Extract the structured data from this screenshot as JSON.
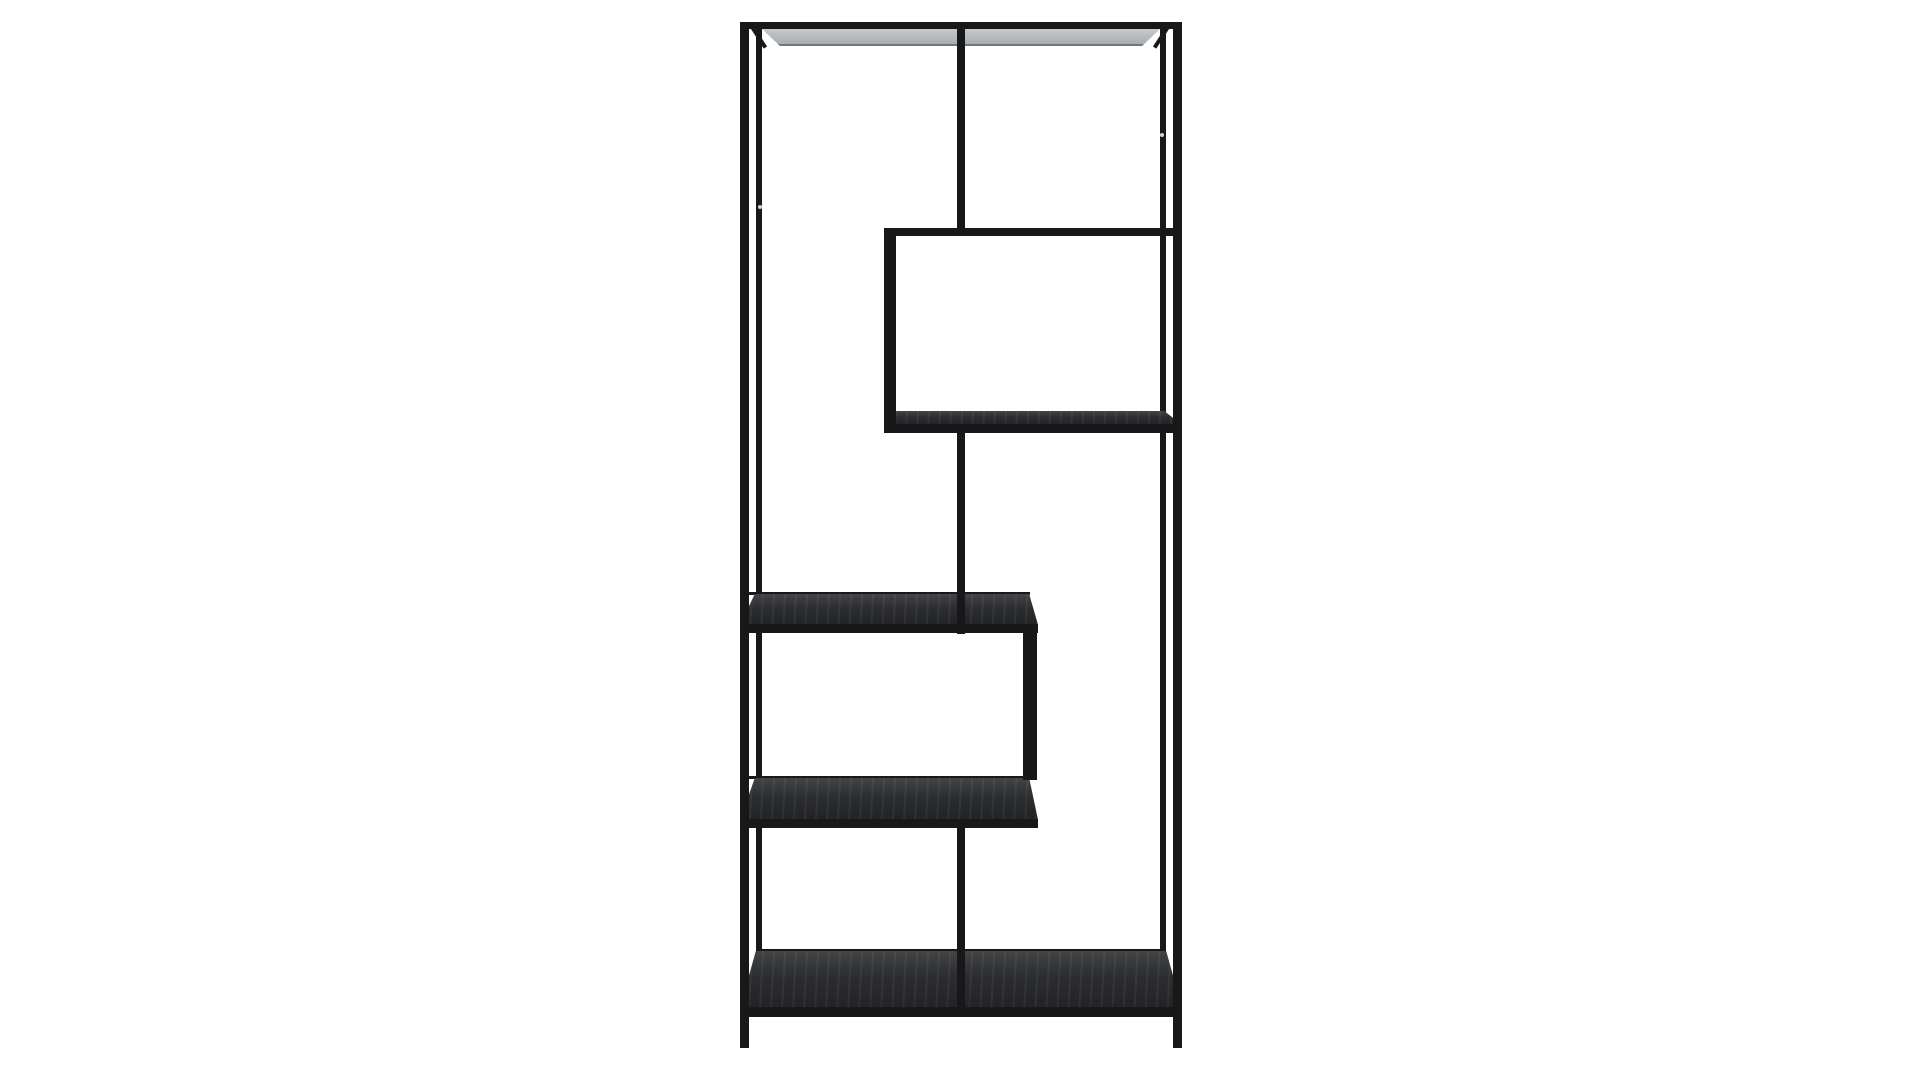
{
  "meta": {
    "image_type": "product-photo",
    "subject": "Tall black metal asymmetric zigzag etagere bookshelf, front view, centered on plain white background",
    "visible_text": "none"
  },
  "palette": {
    "background": "#ffffff",
    "frame": "#18181a",
    "wood_top": "#434446",
    "wood_mid": "#2c2d2f",
    "wood_bottom": "#222325",
    "underside_top": "#c7cacd",
    "underside_bottom": "#a9acb0",
    "underside_edge": "#73767a",
    "screw": "#d2d5d7"
  },
  "scene": {
    "canvas": {
      "width": 1920,
      "height": 1080
    },
    "parts": [
      {
        "name": "back-left-post",
        "kind": "bar",
        "x": 756,
        "y": 28,
        "w": 6,
        "h": 922,
        "z": 1
      },
      {
        "name": "back-right-post",
        "kind": "bar",
        "x": 1160,
        "y": 28,
        "w": 6,
        "h": 922,
        "z": 1
      },
      {
        "name": "top-shelf-underside",
        "kind": "underside",
        "x": 762,
        "y": 29,
        "w": 398,
        "h": 15,
        "z": 1,
        "clip": "polygon(0% 0%, 100% 0%, 95.5% 100%, 4.5% 100%)"
      },
      {
        "name": "top-left-corner-strut",
        "kind": "diag",
        "x": 749,
        "y": 26,
        "w": 4,
        "h": 27,
        "z": 1,
        "rotate": -33,
        "origin": "top left"
      },
      {
        "name": "top-right-corner-strut",
        "kind": "diag",
        "x": 1167,
        "y": 26,
        "w": 4,
        "h": 27,
        "z": 1,
        "rotate": 33,
        "origin": "top right"
      },
      {
        "name": "box-shelf-bottom-surface",
        "kind": "wood",
        "x": 884,
        "y": 411,
        "w": 298,
        "h": 14,
        "z": 2,
        "clip": "polygon(4% 0%, 94% 0%, 100% 100%, 0% 100%)"
      },
      {
        "name": "mid-shelf-back-edge",
        "kind": "bar",
        "x": 748,
        "y": 592,
        "w": 282,
        "h": 3,
        "z": 2
      },
      {
        "name": "mid-shelf-surface",
        "kind": "wood",
        "x": 740,
        "y": 594,
        "w": 298,
        "h": 31,
        "z": 2,
        "clip": "polygon(5% 0%, 97% 0%, 100% 100%, 0% 100%)"
      },
      {
        "name": "lower-shelf-back-edge",
        "kind": "bar",
        "x": 748,
        "y": 776,
        "w": 282,
        "h": 3,
        "z": 2
      },
      {
        "name": "lower-shelf-surface",
        "kind": "wood",
        "x": 740,
        "y": 778,
        "w": 298,
        "h": 42,
        "z": 2,
        "clip": "polygon(5% 0%, 97% 0%, 100% 100%, 0% 100%)"
      },
      {
        "name": "bottom-shelf-back-edge",
        "kind": "bar",
        "x": 756,
        "y": 949,
        "w": 410,
        "h": 3,
        "z": 2
      },
      {
        "name": "bottom-shelf-surface",
        "kind": "wood",
        "x": 740,
        "y": 951,
        "w": 442,
        "h": 57,
        "z": 2,
        "clip": "polygon(3.6% 0%, 96.4% 0%, 100% 100%, 0% 100%)"
      },
      {
        "name": "top-rail",
        "kind": "bar",
        "x": 740,
        "y": 22,
        "w": 442,
        "h": 7,
        "z": 3
      },
      {
        "name": "front-left-post",
        "kind": "bar",
        "x": 740,
        "y": 22,
        "w": 9,
        "h": 1026,
        "z": 3
      },
      {
        "name": "front-right-post",
        "kind": "bar",
        "x": 1173,
        "y": 22,
        "w": 9,
        "h": 1026,
        "z": 3
      },
      {
        "name": "box-shelf-top-rail",
        "kind": "bar",
        "x": 884,
        "y": 228,
        "w": 298,
        "h": 8,
        "z": 3
      },
      {
        "name": "box-shelf-left-wall",
        "kind": "bar",
        "x": 884,
        "y": 228,
        "w": 12,
        "h": 205,
        "z": 3
      },
      {
        "name": "box-shelf-bottom-rail",
        "kind": "bar",
        "x": 884,
        "y": 424,
        "w": 298,
        "h": 9,
        "z": 3
      },
      {
        "name": "mid-shelf-front-rail",
        "kind": "bar",
        "x": 740,
        "y": 624,
        "w": 298,
        "h": 9,
        "z": 3
      },
      {
        "name": "lower-box-right-wall",
        "kind": "bar",
        "x": 1023,
        "y": 630,
        "w": 14,
        "h": 150,
        "z": 3
      },
      {
        "name": "lower-shelf-front-rail",
        "kind": "bar",
        "x": 740,
        "y": 819,
        "w": 298,
        "h": 9,
        "z": 3
      },
      {
        "name": "bottom-shelf-front-rail",
        "kind": "bar",
        "x": 740,
        "y": 1007,
        "w": 442,
        "h": 10,
        "z": 3
      },
      {
        "name": "upper-divider-post",
        "kind": "bar",
        "x": 957,
        "y": 28,
        "w": 8,
        "h": 201,
        "z": 4
      },
      {
        "name": "middle-divider-post",
        "kind": "bar",
        "x": 957,
        "y": 430,
        "w": 8,
        "h": 204,
        "z": 4
      },
      {
        "name": "lower-divider-post",
        "kind": "bar",
        "x": 957,
        "y": 828,
        "w": 8,
        "h": 181,
        "z": 4
      },
      {
        "name": "screw-dot-left",
        "kind": "dot",
        "x": 758,
        "y": 205,
        "w": 4,
        "h": 4,
        "z": 5
      },
      {
        "name": "screw-dot-right",
        "kind": "dot",
        "x": 1160,
        "y": 133,
        "w": 4,
        "h": 4,
        "z": 5
      }
    ]
  }
}
